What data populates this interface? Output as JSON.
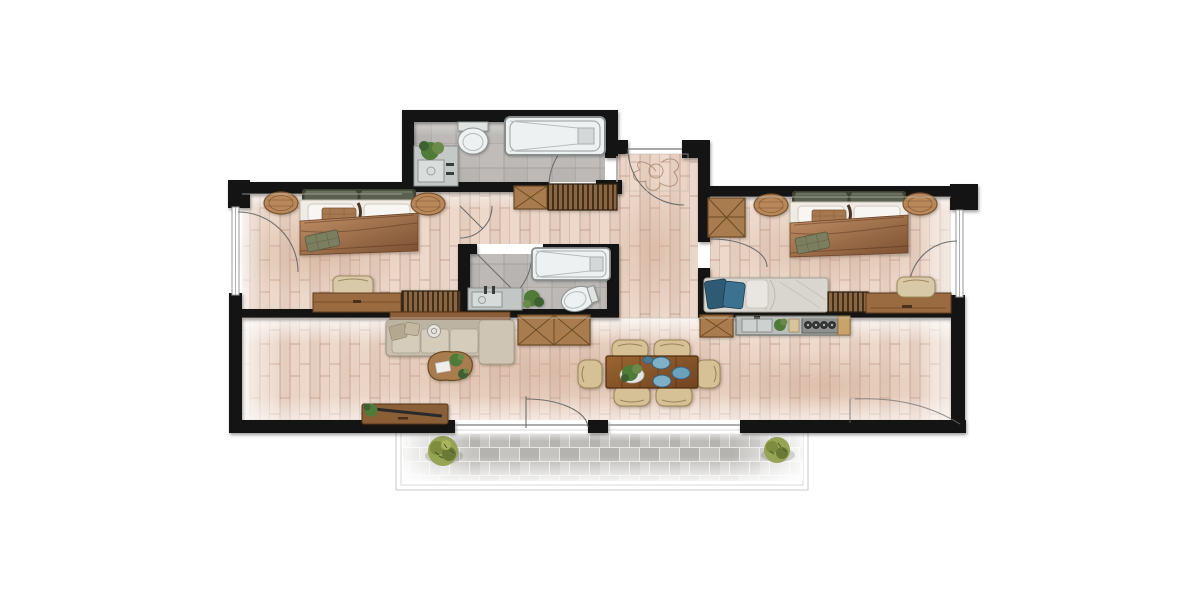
{
  "meta": {
    "title": "Two-bedroom apartment floor plan — rendered top-down view",
    "type": "architectural-floor-plan",
    "style": "color render, white background, black walls, wood-plank flooring"
  },
  "colors": {
    "wall": "#141414",
    "floor-wood": "#e7d3c5",
    "plank": "#b08a74",
    "tile": "#bcb9b6",
    "tile-line": "#a5a19e",
    "paver-a": "#b5b3b0",
    "paver-b": "#c6c4c1",
    "paver-joint": "#e7e6e4",
    "wood": "#9a6b40",
    "wood-dark": "#6b4a26",
    "wood-mid": "#a87c4e",
    "slat": "#8a6644",
    "slat-dark": "#43301a",
    "sofa": "#c9bfae",
    "cushion": "#d5ccbc",
    "chair": "#d6c096",
    "linen": "#efece6",
    "blanket-a": "#c09066",
    "blanket-b": "#7a4e30",
    "headboard": "#596050",
    "pillow-blue": "#2e5a74",
    "pillow-blue2": "#3c7290",
    "plant": "#4f7a38",
    "plant-light": "#6a8a4a",
    "bush": "#97a355",
    "plate": "#7fb0c6",
    "plate-dark": "#33637f",
    "fixture": "#eef1f1",
    "fixture-line": "#8d9292",
    "counter": "#b9bdbb",
    "arc": "#6f6f6f",
    "glass": "#9a9a9a",
    "bg": "#ffffff"
  },
  "rooms": [
    {
      "id": "bedroom-1",
      "label": "Bedroom 1 (left)",
      "furniture": [
        "double-bed",
        "nightstand-left",
        "nightstand-right",
        "bench",
        "dresser",
        "slatted-cabinet",
        "window-left",
        "door-swing"
      ]
    },
    {
      "id": "bathroom-1",
      "label": "Bathroom 1 (top)",
      "furniture": [
        "bathtub",
        "toilet",
        "vanity-sink",
        "plant",
        "door-swing"
      ]
    },
    {
      "id": "entry",
      "label": "Entry",
      "furniture": [
        "entry-door-swing",
        "decor-sketch"
      ]
    },
    {
      "id": "hallway",
      "label": "Hallway",
      "furniture": [
        "sideboard-x",
        "slatted-sideboard"
      ]
    },
    {
      "id": "bathroom-2",
      "label": "Bathroom 2 (en-suite)",
      "furniture": [
        "bathtub",
        "vanity-sink",
        "toilet",
        "plant",
        "door-swing"
      ]
    },
    {
      "id": "bedroom-2",
      "label": "Bedroom 2 (right)",
      "furniture": [
        "wardrobe-x",
        "double-bed",
        "nightstand-left",
        "nightstand-right",
        "daybed-blue-pillows",
        "slatted-bench",
        "desk",
        "desk-chair",
        "window-right",
        "door-swing-left",
        "door-swing-right"
      ]
    },
    {
      "id": "kitchen",
      "label": "Kitchen wall",
      "furniture": [
        "cabinet-x",
        "counter",
        "double-sink",
        "plant",
        "cutting-board",
        "stove-4-burners",
        "wood-end"
      ]
    },
    {
      "id": "living-room",
      "label": "Living room",
      "furniture": [
        "sofa-with-chaise",
        "sofa-back-console",
        "coffee-table-organic",
        "tv-console",
        "sideboard-x2",
        "terrace-door-swing"
      ]
    },
    {
      "id": "dining-area",
      "label": "Dining area",
      "furniture": [
        "dining-table",
        "dining-chair-1",
        "dining-chair-2",
        "dining-chair-3",
        "dining-chair-4",
        "dining-chair-5",
        "dining-chair-6",
        "blue-plates",
        "centerpiece-plant"
      ]
    },
    {
      "id": "terrace",
      "label": "Terrace",
      "furniture": [
        "stone-pavers",
        "bush-left",
        "bush-right",
        "railing-outline"
      ]
    }
  ]
}
